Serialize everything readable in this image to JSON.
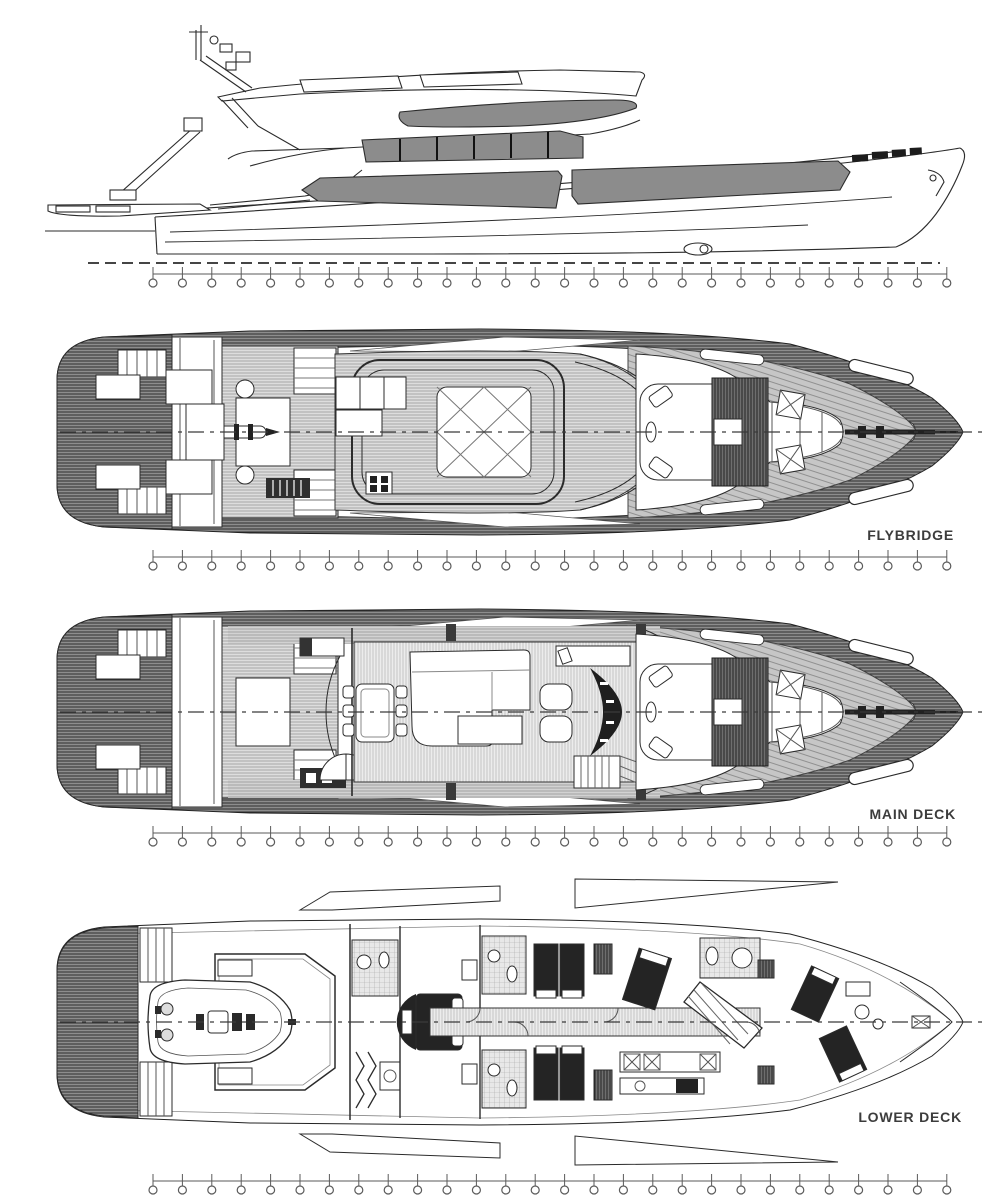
{
  "drawing": {
    "kind": "yacht-general-arrangement",
    "deck_labels": {
      "flybridge": "FLYBRIDGE",
      "main_deck": "MAIN DECK",
      "lower_deck": "LOWER DECK"
    },
    "views": [
      {
        "id": "profile",
        "name": "side-profile"
      },
      {
        "id": "flybridge",
        "name": "flybridge-plan"
      },
      {
        "id": "main-deck",
        "name": "main-deck-plan"
      },
      {
        "id": "lower-deck",
        "name": "lower-deck-plan"
      }
    ],
    "stations": {
      "count": 28,
      "start_x": 153,
      "spacing": 29.4,
      "rows_y": [
        274,
        557,
        833,
        1181
      ]
    },
    "colors": {
      "line": "#2b2b2b",
      "glass": "#8c8c8c",
      "paper": "#ffffff",
      "hull_hatch": "#8d8d8d",
      "teak": "#c6c6c6",
      "bed_dark": "#242424",
      "label_text": "#3c3c3c"
    }
  }
}
